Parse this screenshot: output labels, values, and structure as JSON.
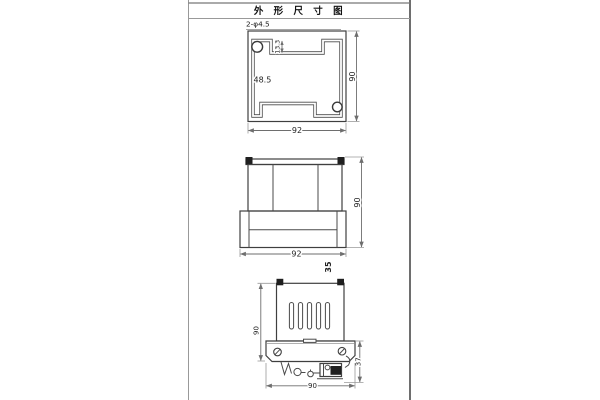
{
  "title_bar": {
    "title": "外 形 尺 寸 图"
  },
  "views": {
    "top": {
      "hole_callout": "2-φ4.5",
      "inner_width": "48.5",
      "notch_depth": "13.3",
      "width": "92",
      "height": "90"
    },
    "front": {
      "width": "92",
      "height": "90",
      "depth": "35"
    },
    "side": {
      "body_height": "90",
      "clip_height": "37",
      "width": "90"
    }
  },
  "colors": {
    "part_line": "#3f3f3f",
    "dimension_line": "#6e6e6e",
    "border_line": "#777777",
    "text": "#1a1a1a"
  }
}
